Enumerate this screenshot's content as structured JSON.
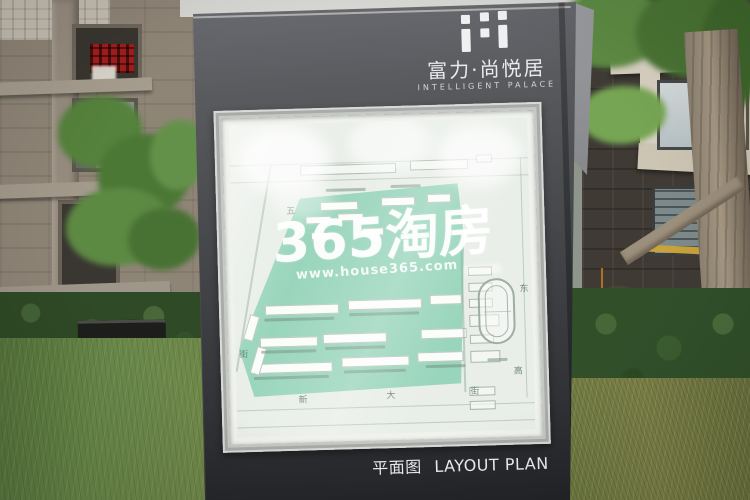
{
  "sign": {
    "logo_icon": "rf-blocks-logo",
    "title": "富力·尚悦居",
    "subtitle": "INTELLIGENT PALACE",
    "caption_zh": "平面图",
    "caption_en": "LAYOUT PLAN",
    "colors": {
      "body": "#46484c",
      "side_panel": "#84868a",
      "caption_text": "#edeff0"
    }
  },
  "map": {
    "frame_color": "#c6c8c5",
    "paper_color": "#e9eee8",
    "parcel_color": "#99d5bc",
    "street_labels": {
      "left_top": "五",
      "left_bottom": "街",
      "bottom": [
        "新",
        "大",
        "街"
      ],
      "right_top": "东",
      "right_bottom": "高"
    }
  },
  "watermark": {
    "brand": "365淘房",
    "url": "www.house365.com",
    "color": "#ffffff"
  },
  "colors": {
    "lawn_green": "#5f7d40",
    "hedge_green": "#2f4a26",
    "stone_building": "#8f8577",
    "dark_building": "#3f3a34",
    "trim_beige": "#cfc6b4"
  }
}
